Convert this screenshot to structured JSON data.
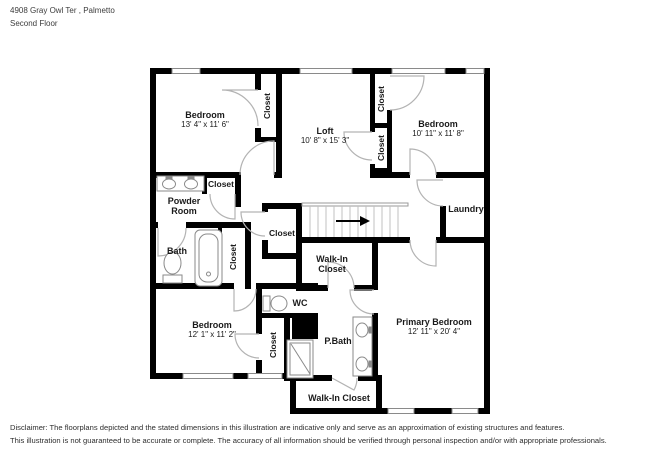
{
  "header": {
    "address": "4908 Gray Owl Ter , Palmetto",
    "floor": "Second Floor"
  },
  "labels": {
    "closet": "Closet",
    "walk_in_line1": "Walk-In",
    "walk_in_line2": "Closet",
    "walk_in_single": "Walk-In Closet"
  },
  "rooms": {
    "bedroom_tl": {
      "name": "Bedroom",
      "dims": "13' 4\" x 11' 6\""
    },
    "loft": {
      "name": "Loft",
      "dims": "10' 8\" x 15' 3\""
    },
    "bedroom_tr": {
      "name": "Bedroom",
      "dims": "10' 11\" x 11' 8\""
    },
    "powder_room": {
      "line1": "Powder",
      "line2": "Room"
    },
    "bath": {
      "name": "Bath"
    },
    "laundry": {
      "name": "Laundry"
    },
    "wc": {
      "name": "WC"
    },
    "bedroom_bl": {
      "name": "Bedroom",
      "dims": "12' 1\" x 11' 2\""
    },
    "p_bath": {
      "name": "P.Bath"
    },
    "primary_bedroom": {
      "name": "Primary Bedroom",
      "dims": "12' 11\" x 20' 4\""
    }
  },
  "disclaimer": {
    "line1": "Disclaimer: The floorplans depicted and the stated dimensions in this illustration are indicative only and serve as an approximation of existing structures and features.",
    "line2": "This illustration is not guaranteed to be accurate or complete. The accuracy of all information should be verified through personal inspection and/or with appropriate professionals."
  },
  "colors": {
    "wall": "#000000",
    "door_arc": "#b3b3b3",
    "fixture": "#8a8a8a",
    "stair": "#c0c0c0",
    "text": "#1a1a1a"
  }
}
